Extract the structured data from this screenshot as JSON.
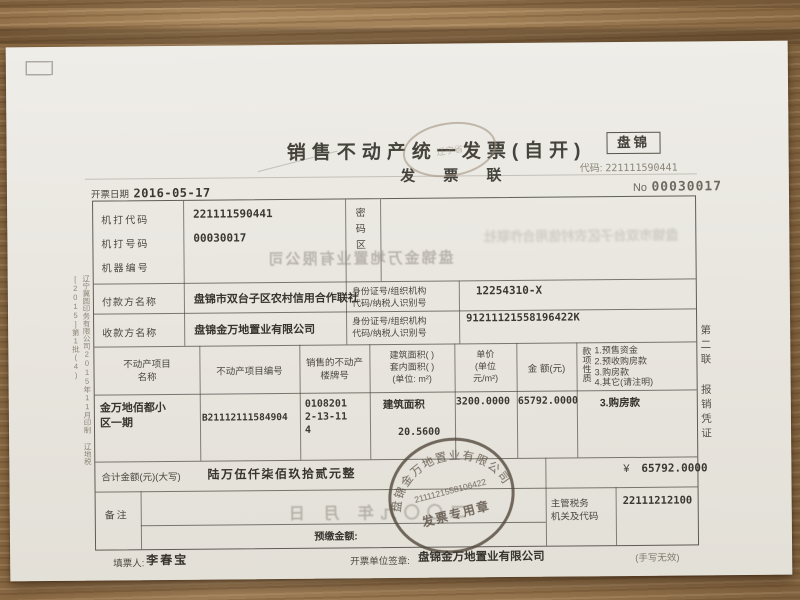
{
  "header": {
    "city": "盘锦",
    "title": "销售不动产统一发票(自开)",
    "copy": "发  票  联",
    "code_label": "代码:",
    "code": "221111590441",
    "no_label": "No",
    "no": "00030017",
    "date_label": "开票日期",
    "date": "2016-05-17",
    "oval_stamp_text": "辽宁省"
  },
  "machine": {
    "code_label": "机打代码",
    "code": "221111590441",
    "number_label": "机打号码",
    "number": "00030017",
    "serial_label": "机器编号",
    "password_label": "密码区",
    "ghost_value": "盘锦金万地置业有限公司",
    "ghost_password": "盘锦市双台子区农村信用合作联社"
  },
  "payer": {
    "label": "付款方名称",
    "name": "盘锦市双台子区农村信用合作联社",
    "id_label": "身份证号/组织机构\n代码/纳税人识别号",
    "id": "12254310-X"
  },
  "payee": {
    "label": "收款方名称",
    "name": "盘锦金万地置业有限公司",
    "id_label": "身份证号/组织机构\n代码/纳税人识别号",
    "id": "91211121558196422K"
  },
  "items": {
    "headers": {
      "name": "不动产项目\n名称",
      "number": "不动产项目编号",
      "building": "销售的不动产\n楼牌号",
      "area": "建筑面积(    )\n套内面积(    )\n(单位: m²)",
      "price": "单价\n(单位\n元/m²)",
      "amount": "金  额(元)",
      "nature_vertical": "款项性质",
      "nature_options": "1.预售资金\n2.预收购房款\n3.购房款\n4.其它(请注明)"
    },
    "row": {
      "name": "金万地佰都小\n区一期",
      "number": "B21112111584904",
      "building": "0108201\n2-13-11\n4",
      "area_type": "建筑面积",
      "area_value": "20.5600",
      "price": "3200.0000",
      "amount": "65792.0000",
      "nature": "3.购房款"
    }
  },
  "total": {
    "label": "合计金额(元)(大写)",
    "in_words": "陆万伍仟柒佰玖拾贰元整",
    "currency": "¥",
    "value": "65792.0000"
  },
  "remarks": {
    "label": "备注",
    "ghost_date": "二〇〇九年  月  日",
    "prepaid_label": "预缴金额:",
    "tax_label": "主管税务\n机关及代码",
    "tax_code": "22111212100"
  },
  "stamp": {
    "company": "盘锦金万地置业有限公司",
    "tax_id": "2111121558106422",
    "caption": "发票专用章"
  },
  "footer": {
    "filler_label": "填票人:",
    "filler": "李春宝",
    "issuer_label": "开票单位签章:",
    "issuer": "盘锦金万地置业有限公司",
    "note": "(手写无效)"
  },
  "sides": {
    "left": "辽宁冀圆印务有限公司2015年11月印制  辽地税[2015]第1批(4)",
    "right": "第二联  报销凭证"
  }
}
